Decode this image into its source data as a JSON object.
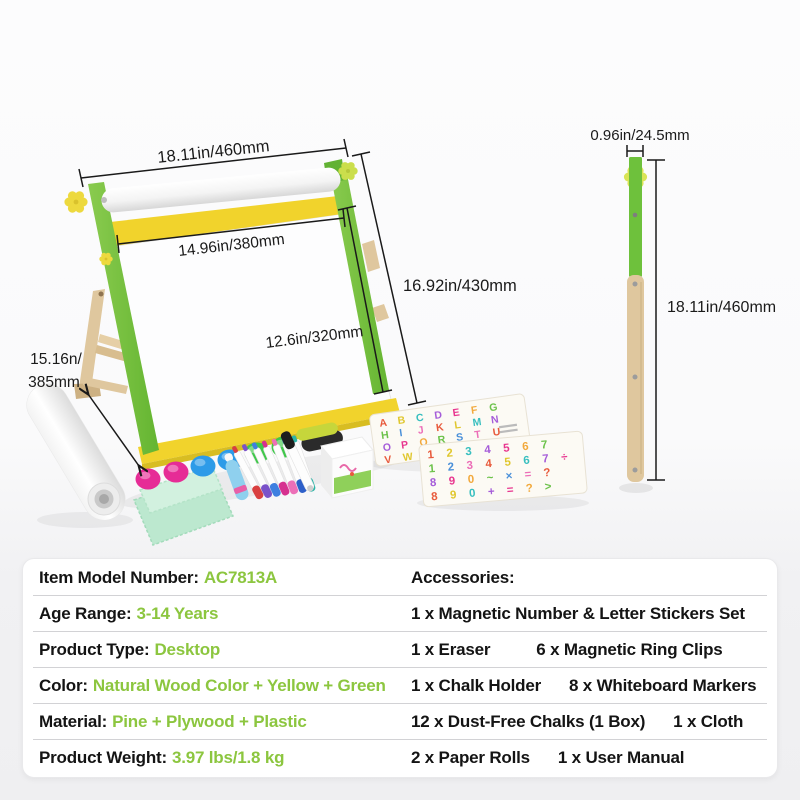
{
  "measurements": {
    "easel_width": "18.11in/460mm",
    "board_width": "14.96in/380mm",
    "easel_height": "16.92in/430mm",
    "board_height": "12.6in/320mm",
    "stand_depth_line1": "15.16n/",
    "stand_depth_line2": "385mm",
    "leg_width": "0.96in/24.5mm",
    "leg_height": "18.11in/460mm"
  },
  "specs": {
    "rows": [
      {
        "label": "Item Model Number:",
        "value": "AC7813A"
      },
      {
        "label": "Age Range:",
        "value": "3-14 Years"
      },
      {
        "label": "Product Type:",
        "value": "Desktop"
      },
      {
        "label": "Color:",
        "value": "Natural Wood Color + Yellow + Green"
      },
      {
        "label": "Material:",
        "value": "Pine + Plywood + Plastic"
      },
      {
        "label": "Product Weight:",
        "value": "3.97 lbs/1.8 kg"
      }
    ],
    "accessories_rows": [
      {
        "a": "Accessories:",
        "b": ""
      },
      {
        "a": "1 x Magnetic Number & Letter Stickers Set",
        "b": ""
      },
      {
        "a": "1 x Eraser",
        "b": "6 x Magnetic Ring Clips"
      },
      {
        "a": "1 x Chalk Holder",
        "b": "8 x Whiteboard Markers"
      },
      {
        "a": "12 x Dust-Free Chalks (1 Box)",
        "b": "1 x Cloth"
      },
      {
        "a": "2 x Paper Rolls",
        "b": "1 x User Manual"
      }
    ]
  },
  "sticker_boards": {
    "letters_rows": [
      "ABCDEFG",
      "HIJKLMN",
      "OPQRSTU",
      "VWXYZ"
    ],
    "numbers_rows": [
      "1234567",
      "1234567÷",
      "890~×=?",
      "890+=?>"
    ],
    "glyph_palette": [
      "#E85A3C",
      "#F2A93C",
      "#E0C72E",
      "#6CC24A",
      "#38BFBF",
      "#4A90D9",
      "#A55CD9",
      "#EC6FB8",
      "#E8368F"
    ]
  },
  "accessory_colors": {
    "magnet_clips": [
      "#E62C96",
      "#E62C96",
      "#2D9BE8",
      "#2D9BE8",
      "#3FC84A",
      "#3FC84A"
    ],
    "marker_caps": [
      "#D94040",
      "#7A52C9",
      "#3E7FE0",
      "#D6308F",
      "#EC6FB8",
      "#2D5FC9",
      "#2BB5A8"
    ],
    "black_marker_cap": "#1E1E1E",
    "chalk_holder_blue": "#8FD0EE",
    "chalk_holder_ring_pink": "#E85FA8",
    "cloth_mint": "#BCE8CF",
    "eraser_top": "#C6D63B"
  },
  "theme": {
    "value_green": "#8CC63F",
    "frame_green": "#6FC13D",
    "frame_yellow": "#F1D32C",
    "wood": "#DFC79E",
    "annotation_black": "#1A1A1A",
    "card_bg": "#FFFFFF"
  }
}
